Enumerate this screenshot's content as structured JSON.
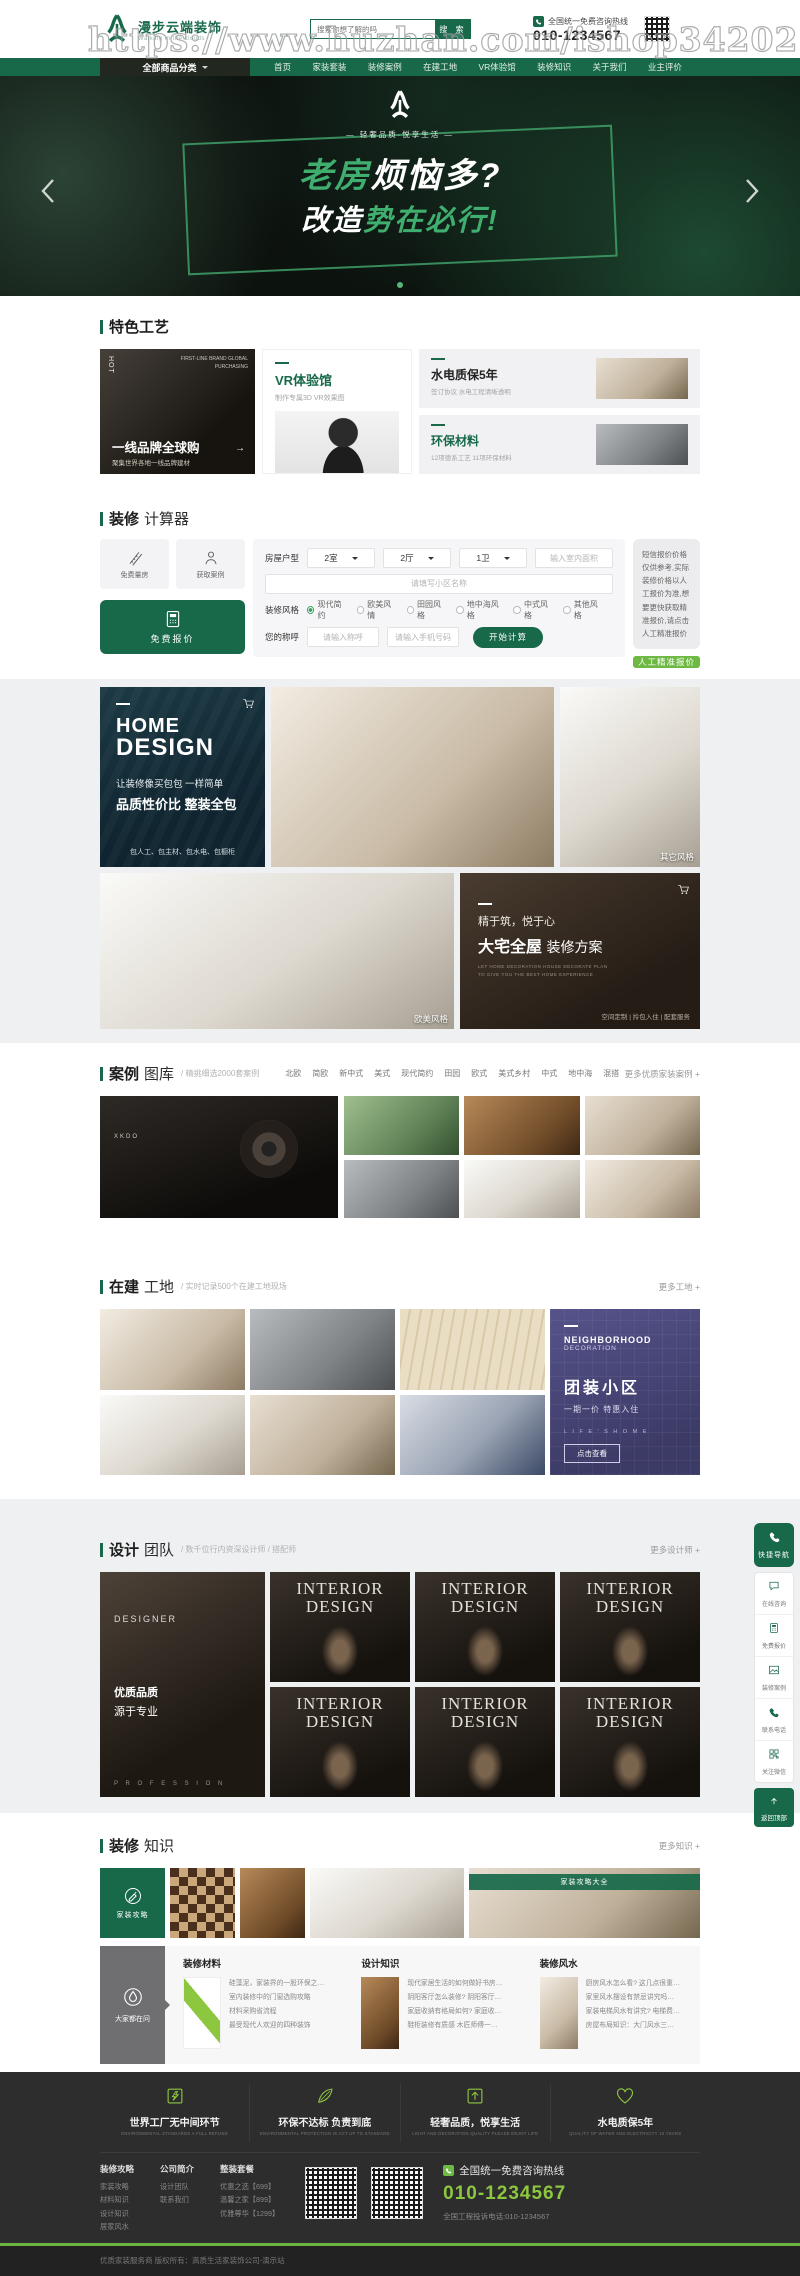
{
  "watermark": "https://www.huzhan.com/ishop34202",
  "header": {
    "logo_title": "漫步云端装饰",
    "logo_subtitle": "Walking in the clouds",
    "search_placeholder": "搜索你想了解的吗",
    "search_button": "搜 索",
    "hotline_label": "全国统一免费咨询热线",
    "hotline_number": "010-1234567"
  },
  "nav": {
    "all_categories": "全部商品分类",
    "items": [
      "首页",
      "家装套装",
      "装修案例",
      "在建工地",
      "VR体验馆",
      "装修知识",
      "关于我们",
      "业主评价"
    ]
  },
  "banner": {
    "tagline": "— 轻奢品质·悦享生活 —",
    "title1_green": "老房",
    "title1_white": "烦恼多?",
    "title2_white": "改造",
    "title2_green": "势在必行!"
  },
  "features": {
    "section_title": "特色工艺",
    "brand": {
      "hot": "HOT",
      "en": "FIRST-LINE BRAND GLOBAL PURCHASING",
      "title": "一线品牌全球购",
      "subtitle": "聚集世界各地一线品牌建材"
    },
    "vr": {
      "title": "VR体验馆",
      "subtitle": "制作专属3D VR效果图"
    },
    "water": {
      "title": "水电质保5年",
      "subtitle": "签订协议 水电工程清晰透明"
    },
    "eco": {
      "title": "环保材料",
      "subtitle": "12项德系工艺 11项环保材料"
    }
  },
  "calculator": {
    "title_bold": "装修",
    "title_light": "计算器",
    "btn_measure": "免费量房",
    "btn_cases": "获取案例",
    "btn_quote": "免费报价",
    "form": {
      "house_label": "房屋户型",
      "rooms": "2室",
      "halls": "2厅",
      "baths": "1卫",
      "area_placeholder": "输入室内面积",
      "community_placeholder": "请填写小区名称",
      "style_label": "装修风格",
      "styles": [
        "现代简约",
        "欧美风情",
        "田园风格",
        "地中海风格",
        "中式风格",
        "其他风格"
      ],
      "name_label": "您的称呼",
      "name_placeholder": "请输入称呼",
      "phone_placeholder": "请输入手机号码",
      "submit": "开始计算"
    },
    "note": "短信报价价格仅供参考,实际装修价格以人工报价为准,想要更快获取精准报价,请点击人工精准报价",
    "note_button": "人工精准报价"
  },
  "showcase": {
    "home_design": {
      "title1": "HOME",
      "title2": "DESIGN",
      "line1": "让装修像买包包 一样简单",
      "line2": "品质性价比  整装全包",
      "line3": "包人工、包主材、包水电、包橱柜"
    },
    "label_other": "其它风格",
    "label_euro": "欧美风格",
    "mansion": {
      "line1": "精于筑，悦于心",
      "line2_bold": "大宅全屋",
      "line2_light": "装修方案",
      "en1": "LET HOME DECORATION HOUSE DECORATE PLAN",
      "en2": "TO GIVE YOU THE BEST HOME EXPERIENCE",
      "links": "空间定制 | 拎包入住 | 配套服务"
    }
  },
  "cases": {
    "title_bold": "案例",
    "title_light": "图库",
    "subtitle": "/ 精挑细选2000套案例",
    "tabs": [
      "北欧",
      "简欧",
      "新中式",
      "美式",
      "现代简约",
      "田园",
      "欧式",
      "美式乡村",
      "中式",
      "地中海",
      "混搭"
    ],
    "more": "更多优质家装案例 +",
    "wall_text": "XKDO"
  },
  "sites": {
    "title_bold": "在建",
    "title_light": "工地",
    "subtitle": "/ 实时记录500个在建工地现场",
    "more": "更多工地 +",
    "neighborhood": {
      "en1": "NEIGHBORHOOD",
      "en2": "DECORATION",
      "title": "团装小区",
      "subtitle": "一期一价 特惠入住",
      "en3": "L I F E ' S  H O M E",
      "button": "点击查看"
    }
  },
  "designers": {
    "title_bold": "设计",
    "title_light": "团队",
    "subtitle": "/ 数千位行内资深设计师 / 搭配师",
    "more": "更多设计师 +",
    "card": {
      "en": "DESIGNER",
      "line1": "优质品质",
      "line2": "源于专业",
      "footer": "P R O F E S S I O N"
    },
    "portrait_line1": "INTERIOR",
    "portrait_line2": "DESIGN"
  },
  "quicknav": {
    "title": "快捷导航",
    "items": [
      "在线咨询",
      "免费报价",
      "装修案例",
      "联系电话",
      "关注微信"
    ],
    "back_top": "返回顶部"
  },
  "knowledge": {
    "title_bold": "装修",
    "title_light": "知识",
    "more": "更多知识 +",
    "card_guide": "家装攻略",
    "banner_label": "家装攻略大全",
    "card_ask": "大家都在问",
    "columns": [
      {
        "title": "装修材料",
        "items": [
          "硅藻泥，家装界的一股环保之…",
          "室内装修中的门窗选购攻略",
          "材料采购省流程",
          "最受现代人欢迎的四种装饰"
        ]
      },
      {
        "title": "设计知识",
        "items": [
          "现代家居生活的如何做好书房…",
          "阴阳客厅怎么装修? 阴阳客厅…",
          "家庭收纳有格局如何? 家庭收…",
          "鞋柜装修有质感 木匠师傅一…"
        ]
      },
      {
        "title": "装修风水",
        "items": [
          "厨房风水怎么看? 这几点很重…",
          "家里风水摆设有禁忌讲究吗…",
          "家装电梯风水有讲究? 电梯费…",
          "房屋布局知识：大门风水三…"
        ]
      }
    ]
  },
  "footer": {
    "features": [
      {
        "title": "世界工厂无中间环节",
        "en": "ENVIRONMENTAL STANDARDS A FULL REFUND"
      },
      {
        "title": "环保不达标 负责到底",
        "en": "ENVIRONMENTAL PROTECTION IS ACT UP TO STANDARD"
      },
      {
        "title": "轻奢品质，悦享生活",
        "en": "LIGHT AND DECORATION QUALITY PLEASE ENJOY LIFE"
      },
      {
        "title": "水电质保5年",
        "en": "QUALITY OF WATER AND ELECTRICITY 10 YEARS"
      }
    ],
    "link_groups": [
      {
        "title": "装修攻略",
        "links": [
          "家装攻略",
          "材料知识",
          "设计知识",
          "居家风水"
        ]
      },
      {
        "title": "公司简介",
        "links": [
          "设计团队",
          "联系我们"
        ]
      },
      {
        "title": "整装套餐",
        "links": [
          "优惠之选【699】",
          "温馨之家【899】",
          "优雅尊华【1299】"
        ]
      }
    ],
    "hotline_label": "全国统一免费咨询热线",
    "hotline_number": "010-1234567",
    "complaint": "全国工程投诉电话:010-1234567",
    "copyright": "优质家装服务商 版权所有：高质生活家装饰公司-演示站"
  }
}
